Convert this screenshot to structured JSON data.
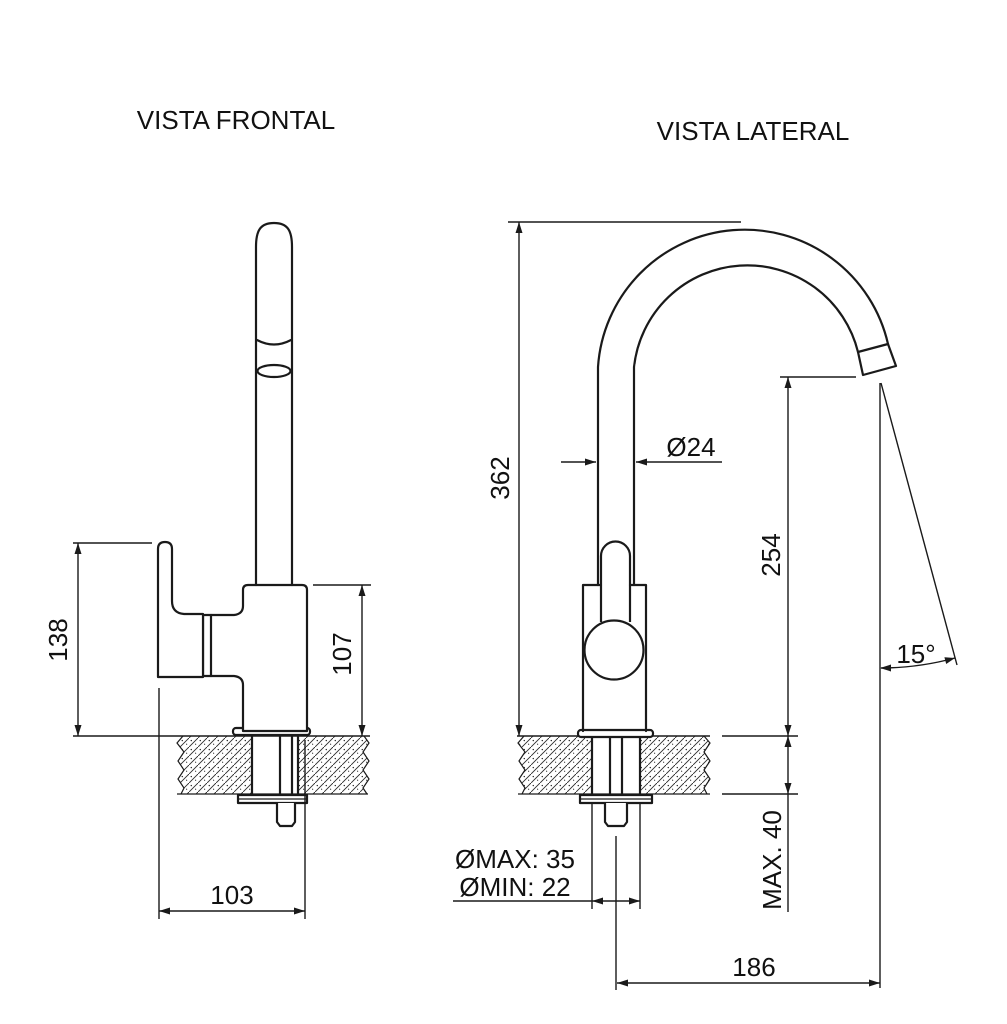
{
  "drawing": {
    "type": "technical-drawing",
    "subject": "faucet installation dimensions",
    "colors": {
      "line": "#1a1a1a",
      "background": "#ffffff"
    },
    "front_view": {
      "title": "VISTA FRONTAL",
      "dim_total_height": "138",
      "dim_body_height": "107",
      "dim_base_width": "103"
    },
    "side_view": {
      "title": "VISTA LATERAL",
      "dim_spout_height": "362",
      "dim_spout_diameter": "Ø24",
      "dim_outlet_height": "254",
      "dim_outlet_angle": "15°",
      "dim_hole_max": "ØMAX: 35",
      "dim_hole_min": "ØMIN: 22",
      "dim_deck_thickness_max": "MAX. 40",
      "dim_reach": "186"
    }
  }
}
